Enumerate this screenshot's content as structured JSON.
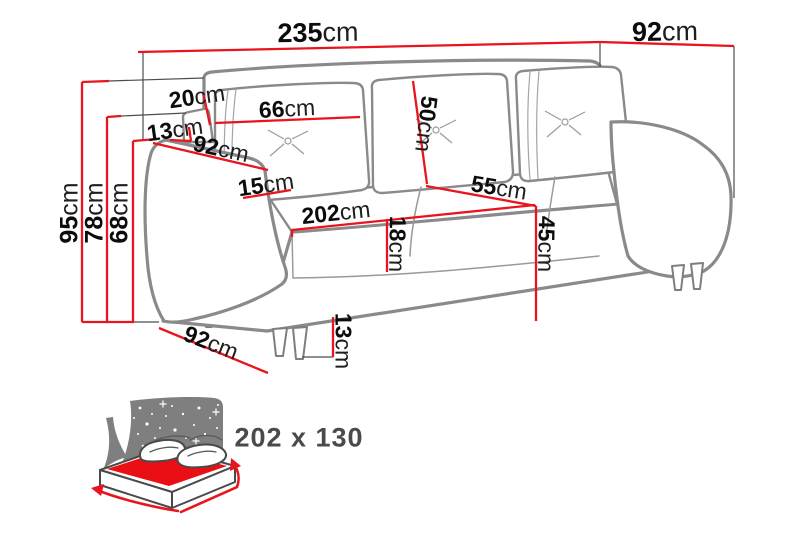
{
  "colors": {
    "dim": "#e8141e",
    "ext": "#4d4d4d",
    "outline": "#8a8a8a",
    "canopy": "#7f7f7f",
    "bedred": "#ea0f14"
  },
  "dimensions": {
    "total_width": {
      "num": "235",
      "unit": "cm"
    },
    "total_depth": {
      "num": "92",
      "unit": "cm"
    },
    "total_height": {
      "num": "95",
      "unit": "cm"
    },
    "back_height": {
      "num": "78",
      "unit": "cm"
    },
    "armrest_height": {
      "num": "68",
      "unit": "cm"
    },
    "headrest_height": {
      "num": "20",
      "unit": "cm"
    },
    "side_panel_height": {
      "num": "13",
      "unit": "cm"
    },
    "back_cushion_width": {
      "num": "66",
      "unit": "cm"
    },
    "armrest_depth": {
      "num": "92",
      "unit": "cm"
    },
    "armrest_width": {
      "num": "15",
      "unit": "cm"
    },
    "seat_width": {
      "num": "202",
      "unit": "cm"
    },
    "seat_cushion_height": {
      "num": "18",
      "unit": "cm"
    },
    "back_cushion_height": {
      "num": "50",
      "unit": "cm"
    },
    "seat_depth": {
      "num": "55",
      "unit": "cm"
    },
    "seat_height": {
      "num": "45",
      "unit": "cm"
    },
    "leg_height": {
      "num": "13",
      "unit": "cm"
    },
    "base_side_depth": {
      "num": "92",
      "unit": "cm"
    }
  },
  "bed": {
    "sleeping_area": "202 x 130"
  }
}
